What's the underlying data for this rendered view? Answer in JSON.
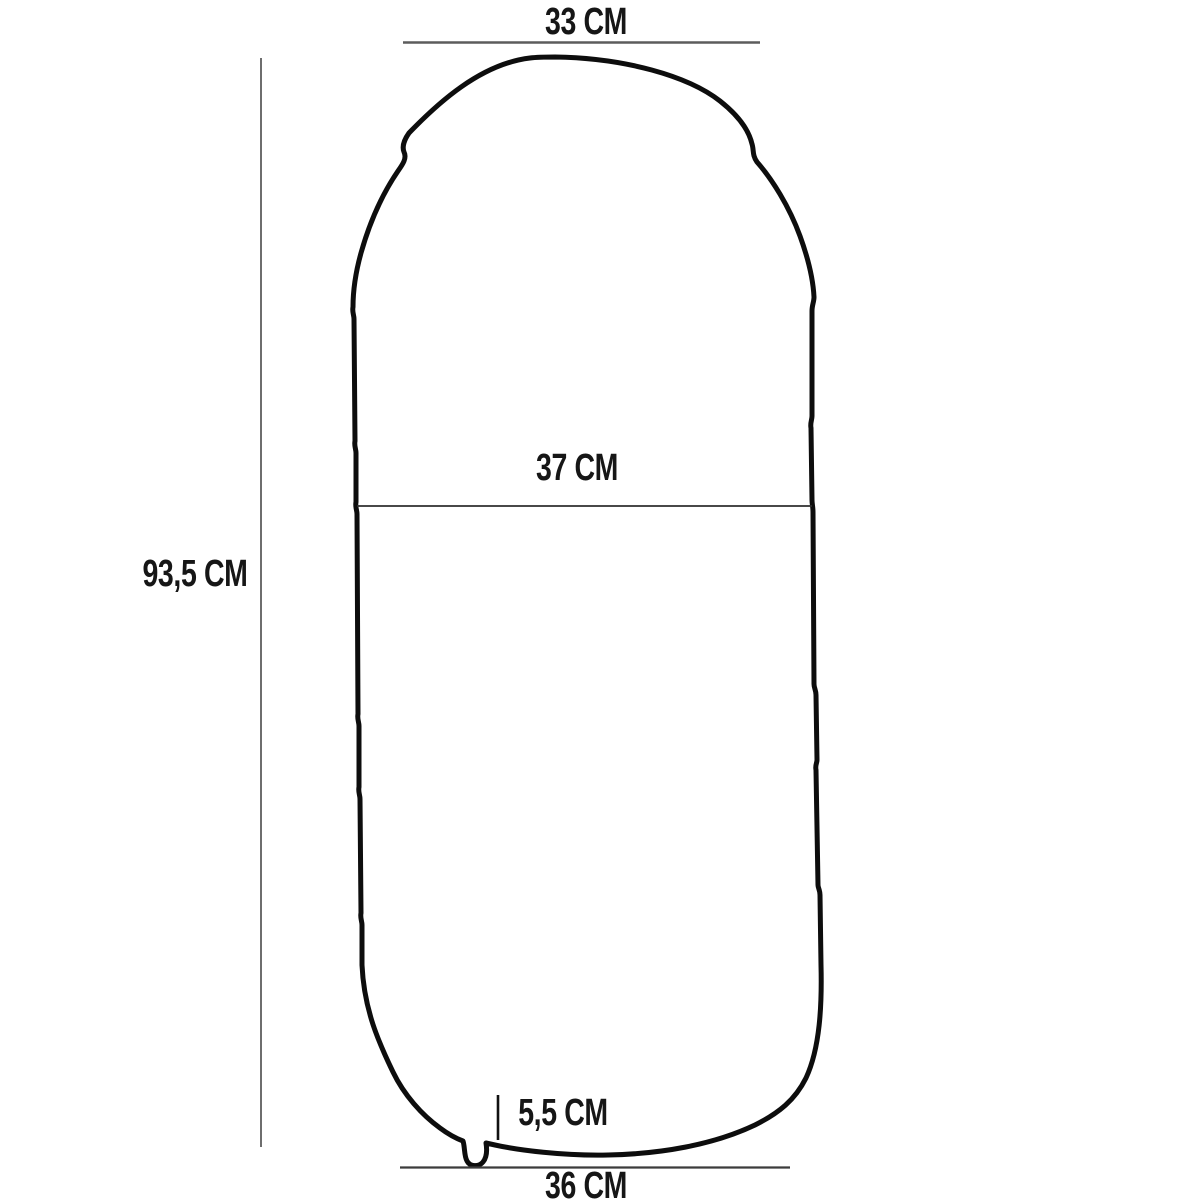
{
  "diagram_type": "product-dimension-drawing",
  "measurements": {
    "top_width": {
      "label": "33 CM"
    },
    "overall_height": {
      "label": "93,5 CM"
    },
    "middle_width": {
      "label": "37 CM"
    },
    "valve_offset": {
      "label": "5,5 CM"
    },
    "bottom_width": {
      "label": "36 CM"
    }
  },
  "colors": {
    "background": "#ffffff",
    "outline": "#0d0d0d",
    "dimension_line_gray": "#5c5c5c",
    "dimension_line_thin": "#2e2e2e",
    "label_text": "#161616"
  }
}
